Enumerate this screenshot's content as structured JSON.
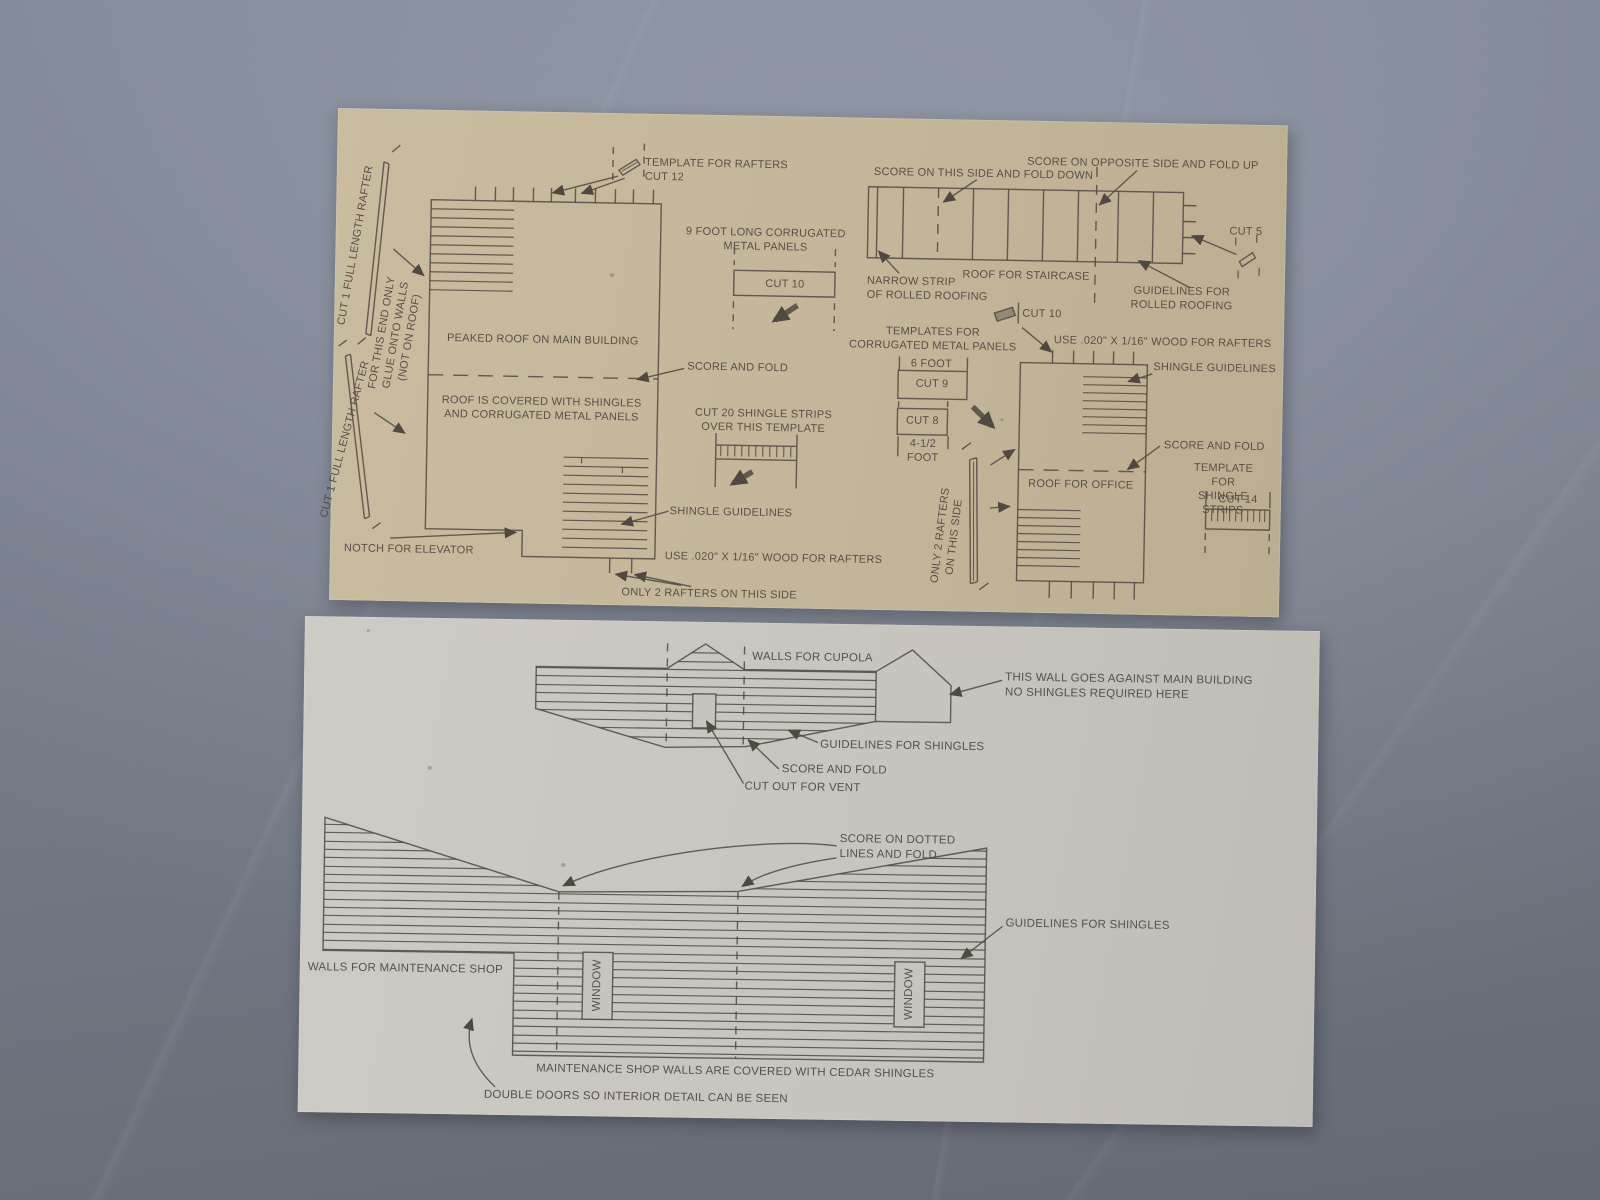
{
  "colors": {
    "floor": "#848b99",
    "top_sheet_cardboard": "#c3b699",
    "bottom_sheet_cardboard": "#c8c5be",
    "ink": "#4e4941"
  },
  "top_sheet": {
    "labels": {
      "template_for_rafters": "TEMPLATE FOR RAFTERS\nCUT 12",
      "nine_foot_panels": "9 FOOT LONG CORRUGATED\nMETAL PANELS",
      "cut_10_box": "CUT 10",
      "score_this_side": "SCORE ON THIS SIDE AND FOLD DOWN",
      "score_opposite_side": "SCORE ON OPPOSITE SIDE AND FOLD UP",
      "roof_for_staircase": "ROOF FOR STAIRCASE",
      "narrow_strip": "NARROW STRIP\nOF ROLLED ROOFING",
      "guidelines_rolled_roofing": "GUIDELINES FOR\nROLLED ROOFING",
      "cut_5": "CUT 5",
      "rafter_1": "CUT 1 FULL LENGTH RAFTER",
      "rafter_2": "CUT 1 FULL LENGTH RAFTER",
      "glue_note": "FOR THIS END ONLY\nGLUE ONTO WALLS\n(NOT ON ROOF)",
      "peaked_roof": "PEAKED ROOF ON MAIN BUILDING",
      "score_and_fold_main": "SCORE AND FOLD",
      "roof_covered": "ROOF IS COVERED WITH SHINGLES\nAND CORRUGATED METAL PANELS",
      "cut_20_strips": "CUT 20 SHINGLE STRIPS\nOVER THIS TEMPLATE",
      "templates_corrugated": "TEMPLATES FOR\nCORRUGATED METAL PANELS",
      "cut_10_small": "CUT 10",
      "six_foot": "6 FOOT",
      "cut_9": "CUT 9",
      "cut_8": "CUT 8",
      "four_half_foot": "4-1/2\nFOOT",
      "use_wood_office": "USE .020\" X 1/16\" WOOD FOR RAFTERS",
      "shingle_guidelines_office": "SHINGLE GUIDELINES",
      "score_and_fold_office": "SCORE AND FOLD",
      "roof_for_office": "ROOF FOR OFFICE",
      "template_shingle_strips": "TEMPLATE FOR\nSHINGLE STRIPS",
      "cut_14": "CUT 14",
      "only_2_rafters_side": "ONLY 2 RAFTERS\nON THIS SIDE",
      "shingle_guidelines_main": "SHINGLE GUIDELINES",
      "use_wood_main": "USE .020\" X 1/16\" WOOD FOR RAFTERS",
      "notch_for_elevator": "NOTCH FOR ELEVATOR",
      "only_2_rafters_bottom": "ONLY 2 RAFTERS ON THIS SIDE"
    }
  },
  "bottom_sheet": {
    "labels": {
      "walls_for_cupola": "WALLS FOR CUPOLA",
      "against_main_building": "THIS WALL GOES AGAINST MAIN BUILDING\nNO SHINGLES REQUIRED HERE",
      "guidelines_shingles_cupola": "GUIDELINES FOR SHINGLES",
      "score_and_fold_cupola": "SCORE AND FOLD",
      "cut_out_vent": "CUT OUT FOR VENT",
      "score_dotted": "SCORE ON DOTTED\nLINES AND FOLD",
      "guidelines_shingles_shop": "GUIDELINES FOR SHINGLES",
      "walls_maintenance_shop": "WALLS FOR MAINTENANCE SHOP",
      "window_1": "WINDOW",
      "window_2": "WINDOW",
      "cedar_shingles_note": "MAINTENANCE SHOP WALLS ARE COVERED WITH CEDAR SHINGLES",
      "double_doors_note": "DOUBLE DOORS SO INTERIOR DETAIL CAN BE SEEN"
    }
  }
}
